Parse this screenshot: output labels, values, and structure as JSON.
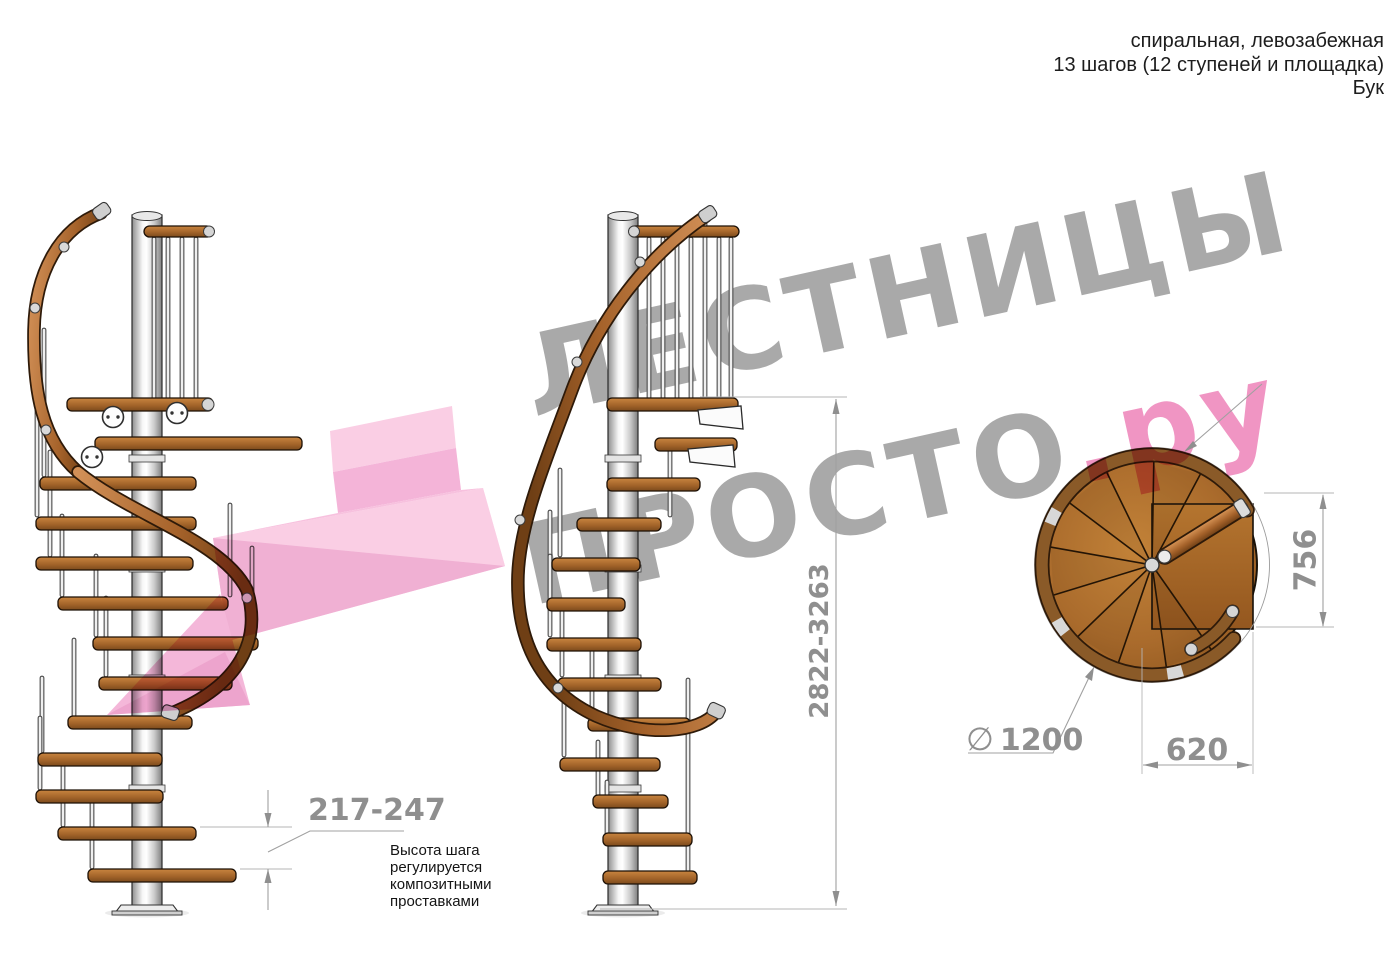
{
  "header": {
    "line1": "спиральная, левозабежная",
    "line2": "13 шагов (12 ступеней и площадка)",
    "line3": "Бук"
  },
  "watermark": {
    "word1": "ЛЕСТНИЦЫ",
    "word2": "ПРОСТО",
    "suffix": ".ру"
  },
  "dimensions": {
    "step_height": "217-247",
    "total_height": "2822-3263",
    "plan_depth": "756",
    "plan_width": "620",
    "diameter_symbol": "∅",
    "diameter": "1200"
  },
  "note": {
    "line1": "Высота шага",
    "line2": "регулируется",
    "line3": "композитными",
    "line4": "проставками"
  },
  "colors": {
    "wood": "#a4652a",
    "wood_dark": "#8a5a28",
    "steel": "#ededed",
    "pink_accent": "#ef8fc0",
    "watermark_gray": "#969696",
    "dimension_gray": "#8f8f8f"
  }
}
